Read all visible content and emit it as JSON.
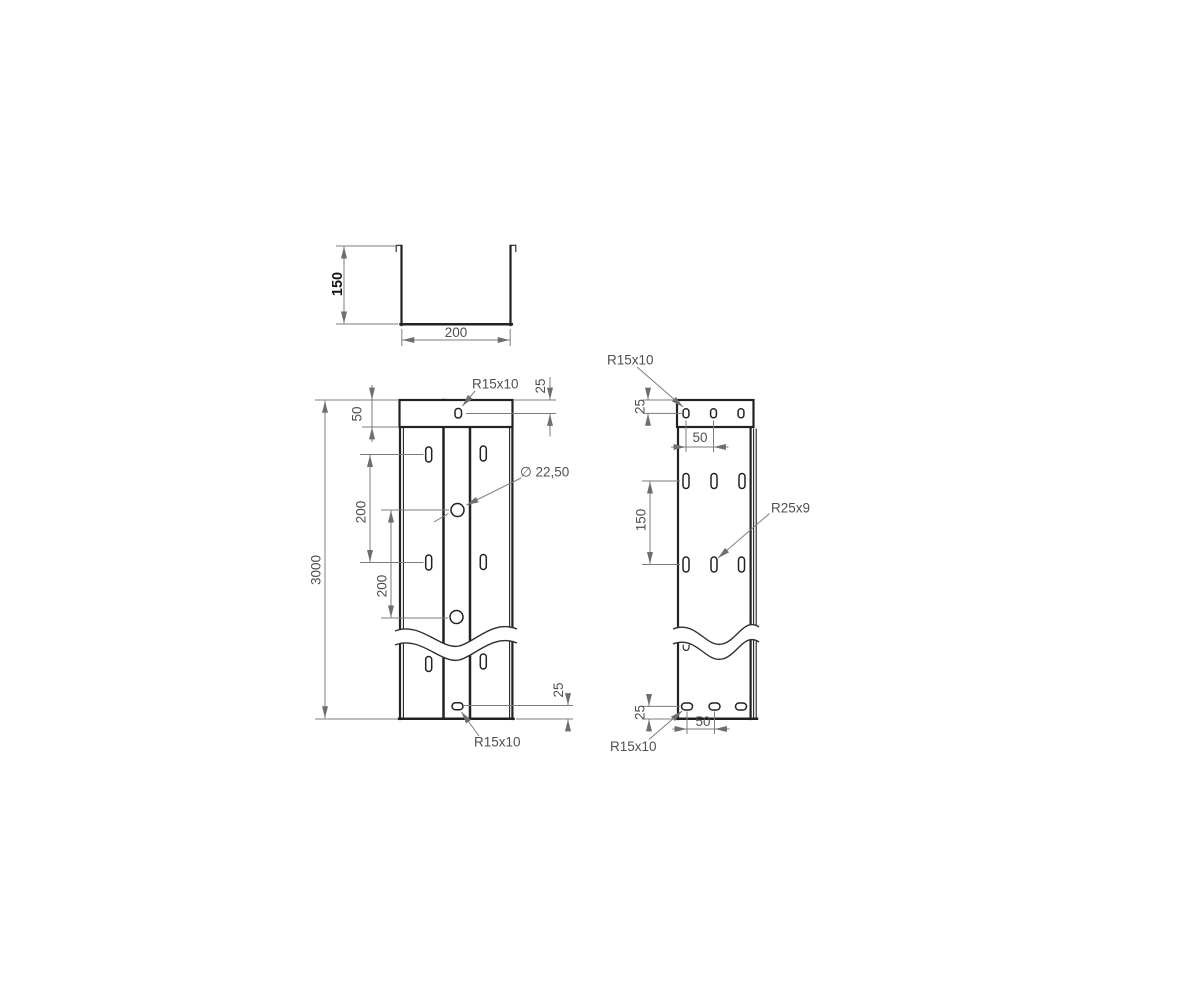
{
  "colors": {
    "background": "#ffffff",
    "part_line": "#222222",
    "dimension_line": "#7c7c7c",
    "dimension_text": "#4f4f4f",
    "bold_text": "#141414"
  },
  "cross_section": {
    "height": "150",
    "width": "200"
  },
  "front_view": {
    "overall_length": "3000",
    "end_zone_height": "50",
    "pitch_upper": "200",
    "pitch_lower": "200",
    "slot_label_top": "R15x10",
    "slot_label_bottom": "R15x10",
    "hole_diameter": "∅ 22,50",
    "edge_offset_top": "25",
    "edge_offset_bottom": "25"
  },
  "side_view": {
    "slot_label_top": "R15x10",
    "slot_label_middle": "R25x9",
    "slot_label_bottom": "R15x10",
    "edge_offset_top": "25",
    "edge_offset_bottom": "25",
    "pitch_top": "50",
    "pitch_bottom": "50",
    "row_pitch": "150"
  }
}
